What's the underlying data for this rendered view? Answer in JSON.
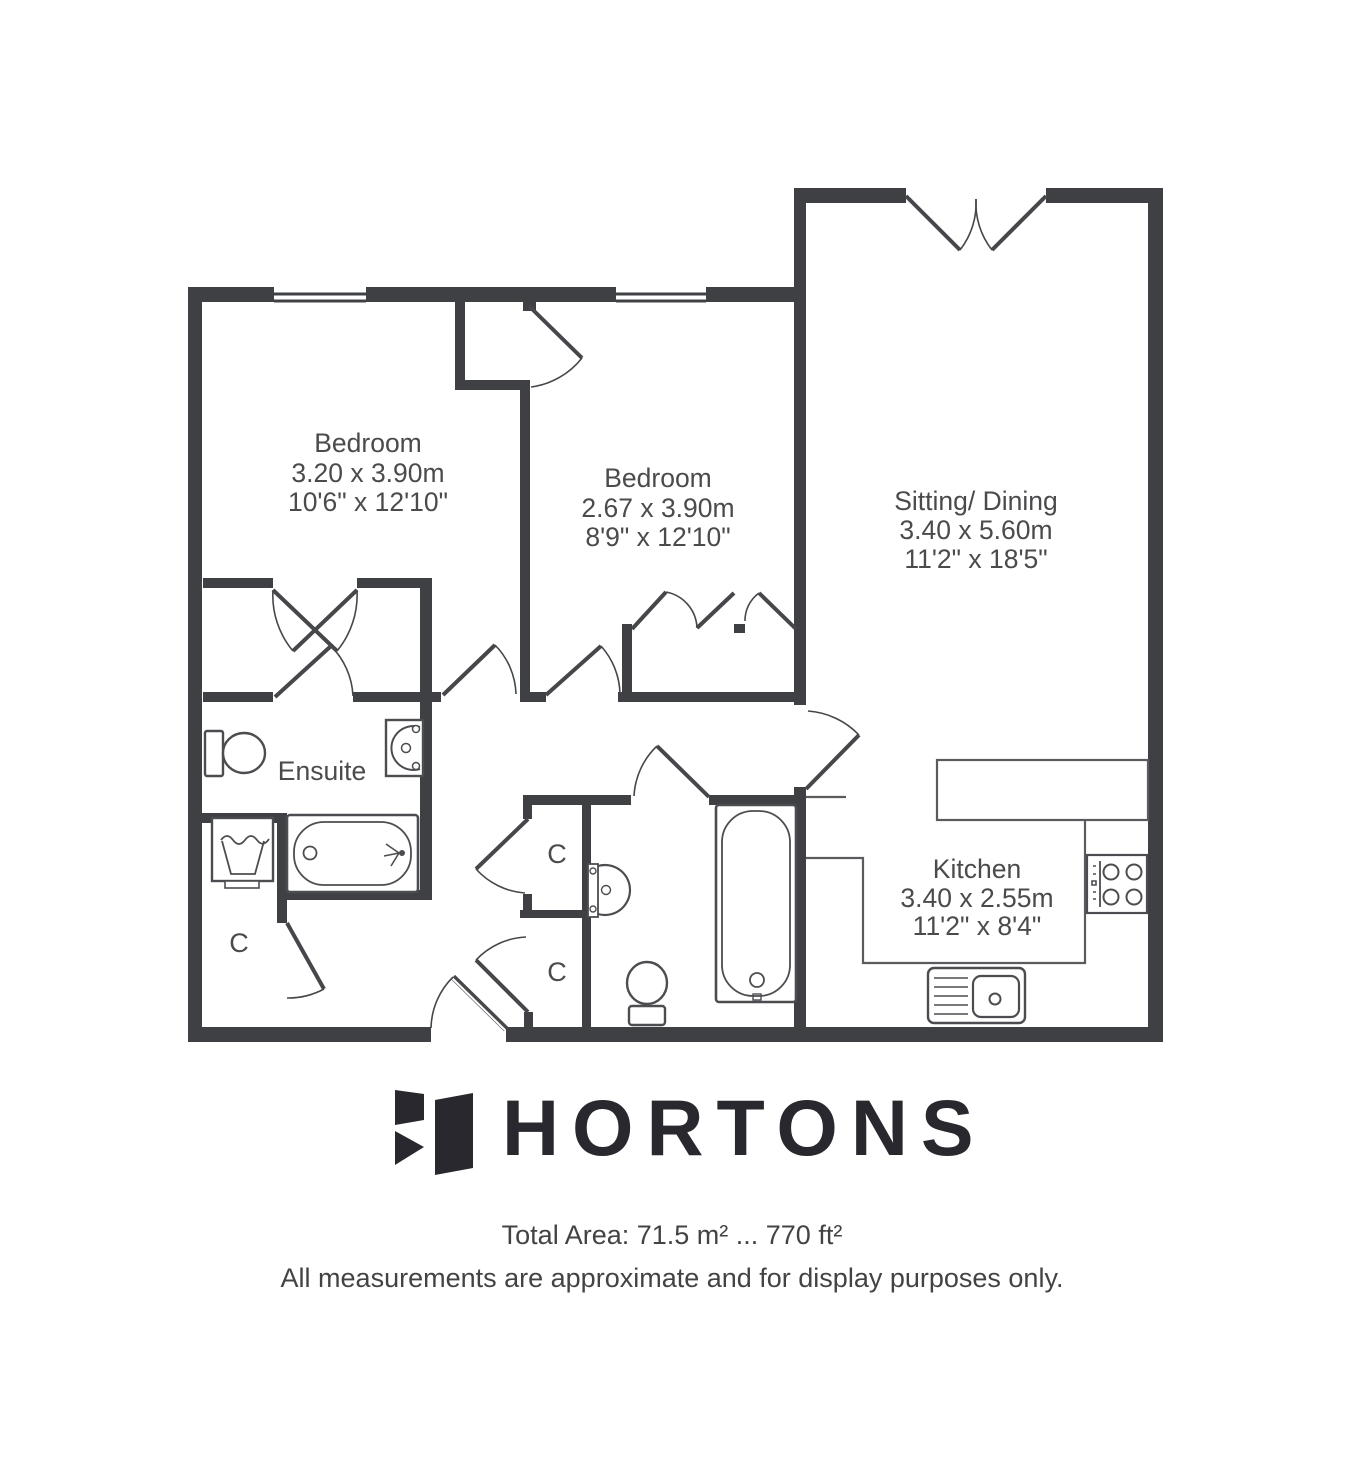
{
  "plan": {
    "rooms": {
      "bedroom1": {
        "name": "Bedroom",
        "metric": "3.20 x 3.90m",
        "imperial": "10'6\" x 12'10\""
      },
      "bedroom2": {
        "name": "Bedroom",
        "metric": "2.67 x 3.90m",
        "imperial": "8'9\" x 12'10\""
      },
      "sitting": {
        "name": "Sitting/ Dining",
        "metric": "3.40 x 5.60m",
        "imperial": "11'2\" x 18'5\""
      },
      "kitchen": {
        "name": "Kitchen",
        "metric": "3.40 x 2.55m",
        "imperial": "11'2\" x 8'4\""
      },
      "ensuite": {
        "name": "Ensuite"
      },
      "closet_label": "C"
    },
    "icons": {
      "fixtures": [
        "toilet",
        "washbasin",
        "bath-with-shower",
        "washing-machine",
        "bathtub",
        "wc",
        "hob",
        "kitchen-sink",
        "window",
        "door-swing",
        "bifold-wardrobe-doors"
      ]
    },
    "colors": {
      "wall": "#3f4044",
      "fixture": "#4c4d50",
      "text": "#4a4b4d",
      "logo": "#28282e"
    }
  },
  "footer": {
    "brand": "HORTONS",
    "total_area": "Total Area: 71.5 m² ... 770 ft²",
    "disclaimer": "All measurements are approximate and for display purposes only."
  }
}
